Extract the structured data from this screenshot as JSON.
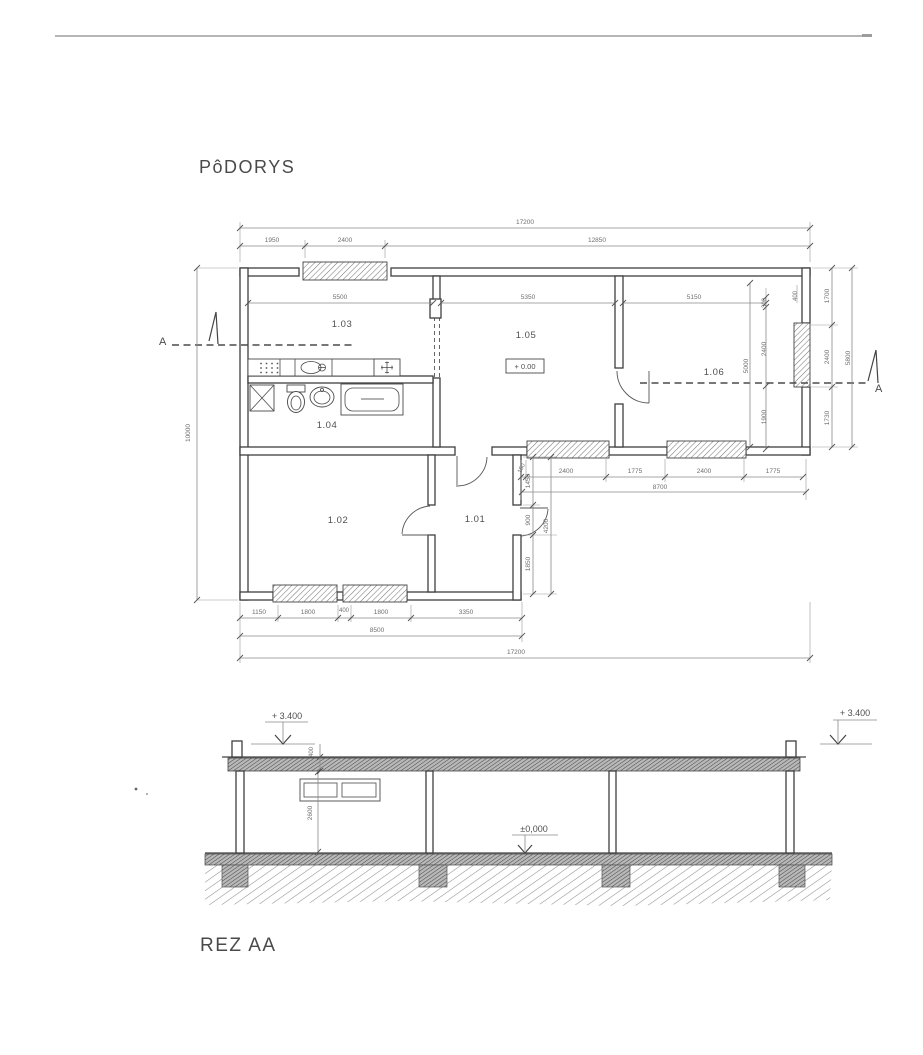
{
  "titles": {
    "plan": "PôDORYS",
    "section": "REZ AA"
  },
  "plan": {
    "rooms": {
      "r101": "1.01",
      "r102": "1.02",
      "r103": "1.03",
      "r104": "1.04",
      "r105": "1.05",
      "r106": "1.06"
    },
    "level_box": "+ 0.00",
    "section_marker": "A",
    "dims": {
      "top_total": "17200",
      "top_a": "1950",
      "top_b": "2400",
      "top_c": "12850",
      "w103": "5500",
      "w105": "5350",
      "w106": "5150",
      "v300": "300",
      "v400": "400",
      "in5000": "5000",
      "in2400": "2400",
      "in1900": "1900",
      "o1700": "1700",
      "o2400": "2400",
      "o1730": "1730",
      "o5800": "5800",
      "left_total": "10000",
      "mid150": "150",
      "mid2400a": "2400",
      "mid1775a": "1775",
      "mid2400b": "2400",
      "mid1775b": "1775",
      "mid_total": "8700",
      "h1450": "1450",
      "h900": "900",
      "h1850": "1850",
      "h4200": "4200",
      "b1150": "1150",
      "b1800a": "1800",
      "b400": "400",
      "b1800b": "1800",
      "b3350": "3350",
      "b8500": "8500",
      "b17200": "17200"
    }
  },
  "section": {
    "levels": {
      "roof_left": "+ 3.400",
      "roof_right": "+ 3.400",
      "floor": "±0,000"
    },
    "dims": {
      "roof_thickness": "400",
      "room_height": "2600"
    }
  }
}
